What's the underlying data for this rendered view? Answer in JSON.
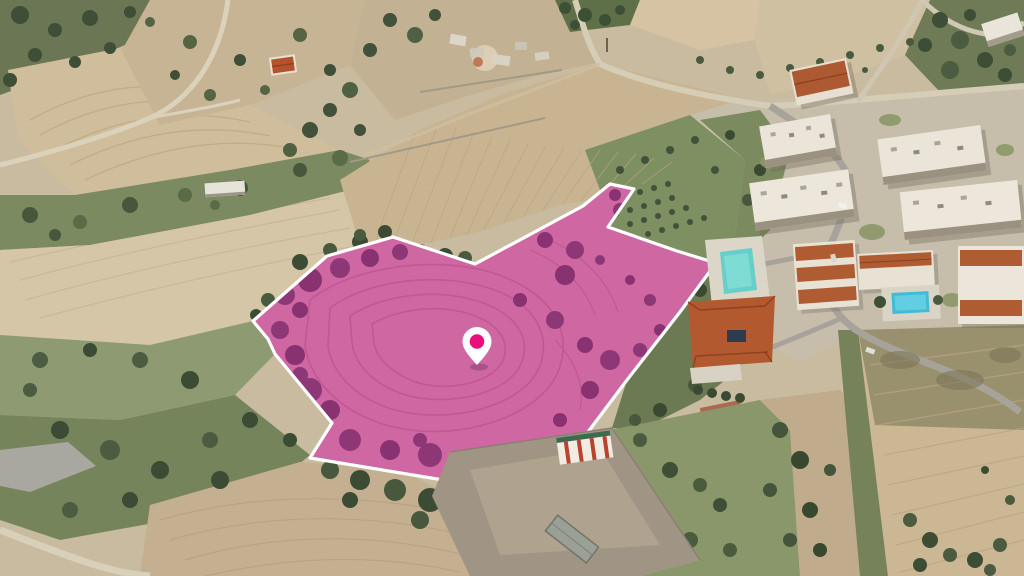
{
  "scene": {
    "type": "aerial-drone-photo",
    "description": "Aerial view of a land parcel for sale highlighted in pink with a white boundary and location pin, surrounded by farmland, orchards and a residential complex",
    "features": [
      "highlighted land parcel",
      "location pin",
      "ploughed fields",
      "terraced field",
      "olive orchard",
      "farm ruins",
      "rural roads",
      "apartment complex",
      "terracotta roofed houses",
      "villa with solar panels",
      "two swimming pools",
      "storage sheds",
      "scrubland"
    ],
    "palette": {
      "field_tan": "#c9b493",
      "field_pale": "#d6c6a8",
      "scrub_green": "#6e7a58",
      "grass_green": "#8e9b72",
      "orchard_green": "#7e8f62",
      "road_light": "#d6cdb6",
      "road_asphalt": "#a7a39a",
      "building_white": "#ece7da",
      "roof_terracotta": "#b2592f",
      "pool_blue": "#41bcd6",
      "pool_teal": "#66cfc9"
    }
  },
  "parcel": {
    "points": "253,321 327,256 393,237 475,264 583,206 610,184 634,189 608,227 677,251 716,263 680,312 627,380 588,432 563,447 480,486 310,458 332,423 275,354 268,339",
    "fill_color": "rgba(213,32,176,0.52)",
    "border_color": "#ffffff",
    "border_width": "3.2"
  },
  "pin": {
    "transform": "translate(477,351)",
    "x": 477,
    "y": 351,
    "body_color": "#ffffff",
    "dot_color": "#ea0f7c"
  }
}
